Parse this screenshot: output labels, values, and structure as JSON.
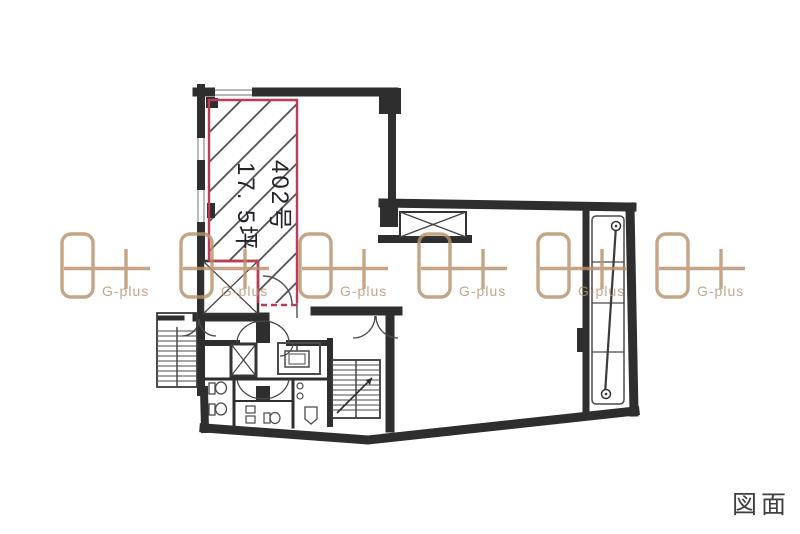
{
  "page": {
    "background": "#ffffff"
  },
  "floor_plan": {
    "unit": {
      "number": "402号",
      "area": "17. 5坪"
    },
    "highlight_color": "#bf3a55",
    "wall_color": "#2e2e2e",
    "hatch_color": "#4a4a52"
  },
  "watermark": {
    "label": "G-plus",
    "color": "#b8926d",
    "count": 6
  },
  "footer": {
    "label": "図面"
  }
}
